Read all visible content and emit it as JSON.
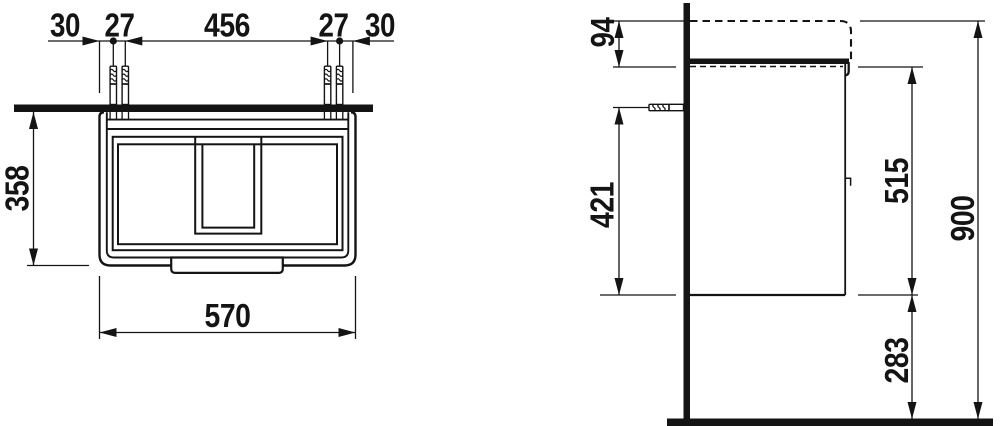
{
  "drawing": {
    "type": "technical-installation-drawing",
    "subject": "wall-mounted vanity unit with washbasin",
    "units": "mm",
    "colors": {
      "line": "#141414",
      "background": "#ffffff"
    },
    "plan_view": {
      "chain": [
        "30",
        "27",
        "456",
        "27",
        "30"
      ],
      "depth": "358",
      "width": "570"
    },
    "side_view": {
      "basin_rim_to_cabinet_top": "94",
      "anchor_to_cabinet_bottom": "421",
      "cabinet_height": "515",
      "floor_to_cabinet_bottom": "283",
      "overall_height": "900"
    }
  }
}
